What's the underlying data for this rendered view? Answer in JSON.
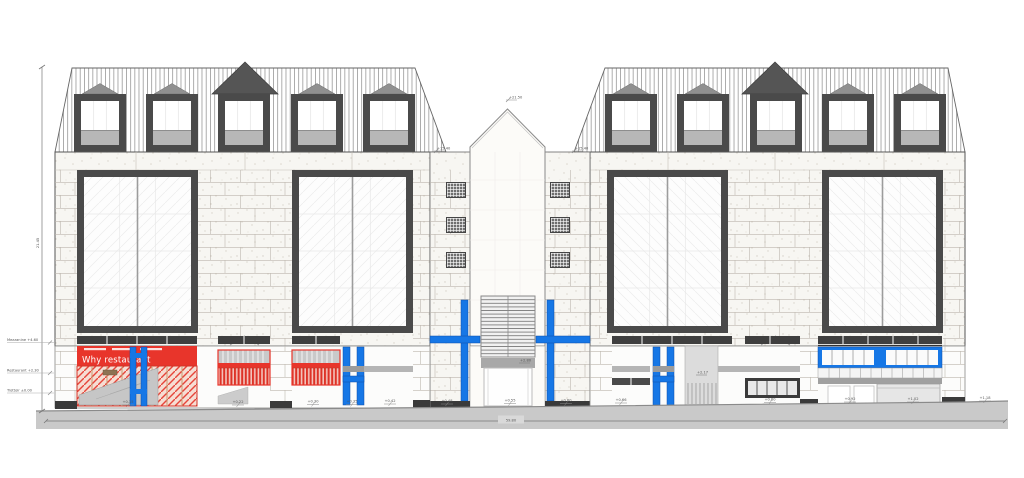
{
  "drawing": {
    "type": "Architectural street elevation",
    "banner": {
      "text": "Why restaurant"
    },
    "dimensions": {
      "total_height": "21.45",
      "total_width": "59.80"
    },
    "levels_left": [
      {
        "label": "Mezzanine  +4.60"
      },
      {
        "label": "Restaurant  +2.30"
      },
      {
        "label": "Trottoir  ±0.00"
      }
    ],
    "level_marks": {
      "peak": "+21.50",
      "tower_left": "+15.40",
      "tower_right": "+15.40",
      "door_lintel": "+2.80",
      "entry_right": "+2.17"
    },
    "ground_marks": [
      "+0.15",
      "+0.22",
      "+0.30",
      "+0.35",
      "+0.42",
      "+0.48",
      "+0.55",
      "+0.60",
      "+0.66",
      "+0.80",
      "+0.92",
      "+1.02",
      "+1.18"
    ],
    "colors": {
      "accent_blue": "#1677e6",
      "accent_red": "#e8352b",
      "frame_dark": "#4a4a4a",
      "spandrel_gray": "#b7b7b7",
      "ground_gray": "#c9c9c9",
      "stone": "#f7f6f2"
    }
  }
}
